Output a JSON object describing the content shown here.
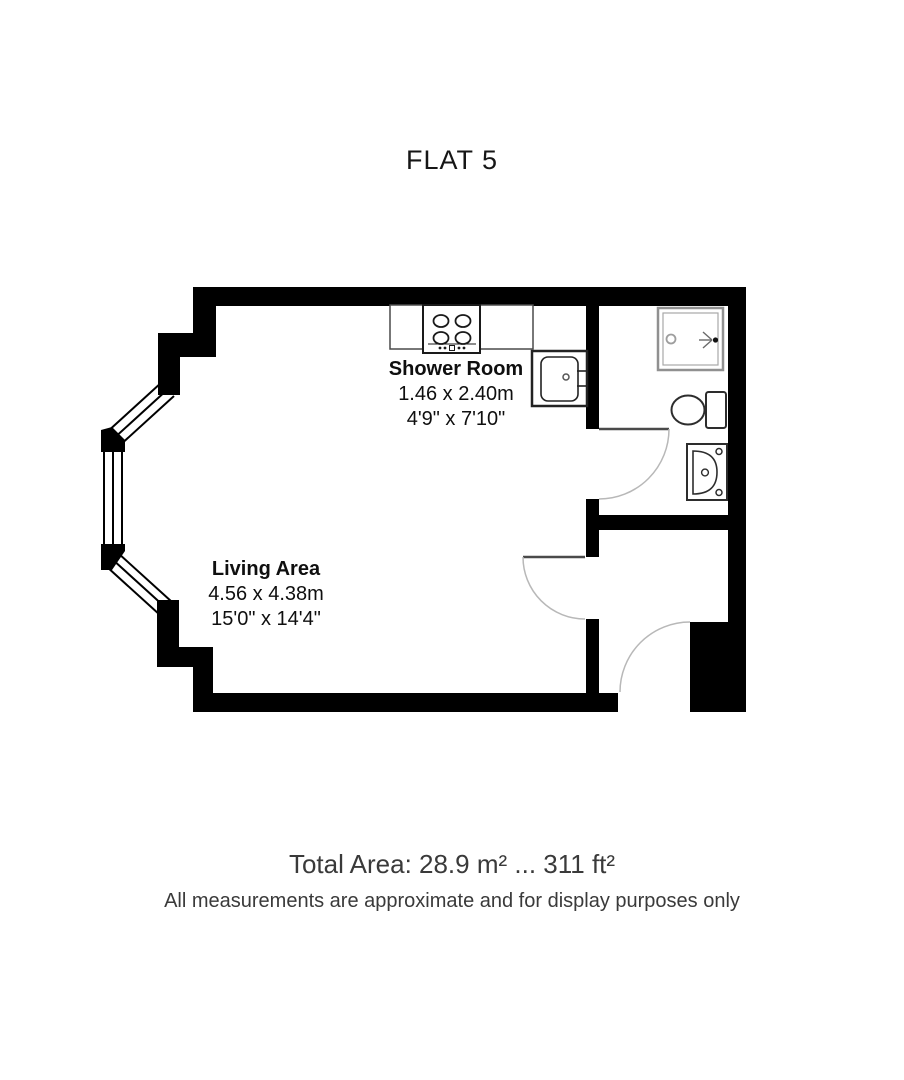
{
  "title": "FLAT 5",
  "rooms": {
    "shower": {
      "name": "Shower Room",
      "metric": "1.46 x 2.40m",
      "imperial": "4'9\" x 7'10\""
    },
    "living": {
      "name": "Living Area",
      "metric": "4.56 x 4.38m",
      "imperial": "15'0\" x 14'4\""
    }
  },
  "footer": {
    "total_area": "Total Area: 28.9 m² ... 311 ft²",
    "disclaimer": "All measurements are approximate and for display purposes only"
  },
  "plan": {
    "fixtures": [
      "hob-icon",
      "washing-machine-icon",
      "shower-tray-icon",
      "toilet-icon",
      "basin-icon"
    ],
    "features": [
      "bay-window",
      "shower-room-door",
      "living-hall-door",
      "entrance-door"
    ],
    "colors": {
      "wall": "#000000",
      "fixture_line": "#2f2f2f",
      "shower_tray_line": "#909090",
      "door_arc": "#b8b8b8",
      "door_leaf": "#4a4a4a",
      "text": "#0f0f0f",
      "footer_text": "#3a3a3a",
      "background": "#ffffff"
    }
  }
}
